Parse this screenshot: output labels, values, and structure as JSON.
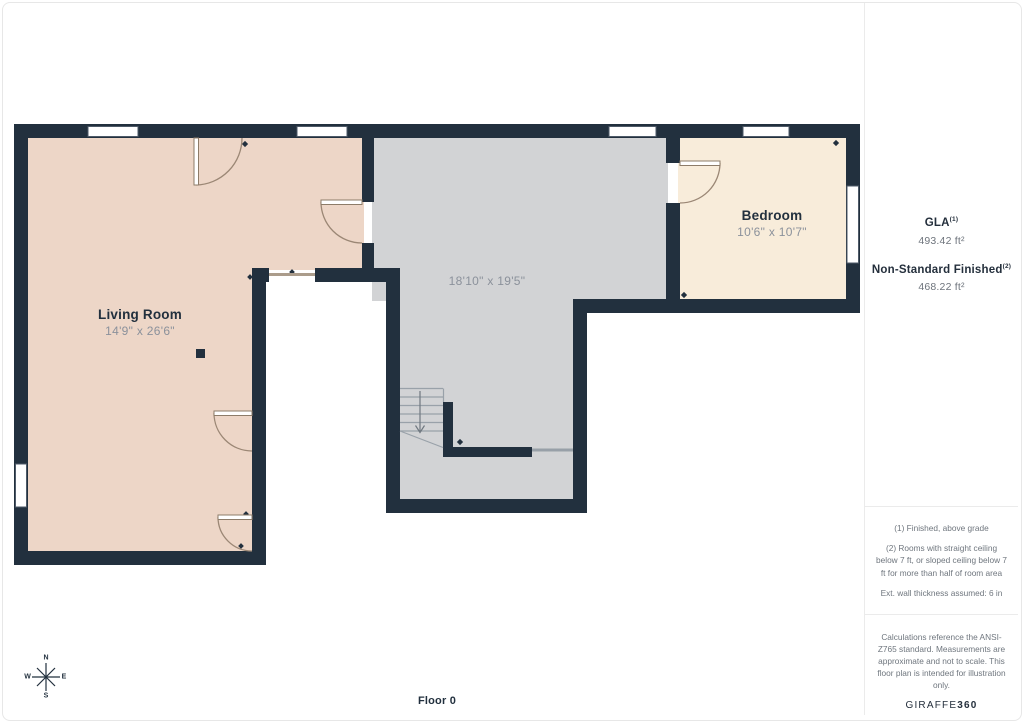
{
  "floor_plan": {
    "floor_label": "Floor 0",
    "rooms": {
      "living_room": {
        "name": "Living Room",
        "dimensions": "14'9\" x 26'6\""
      },
      "main_area": {
        "dimensions": "18'10\" x 19'5\""
      },
      "bedroom": {
        "name": "Bedroom",
        "dimensions": "10'6\" x 10'7\""
      }
    },
    "compass": {
      "north": "N",
      "south": "S",
      "east": "E",
      "west": "W"
    }
  },
  "sidebar": {
    "gla_label": "GLA",
    "gla_superscript": "(1)",
    "gla_value": "493.42 ft²",
    "nsf_label": "Non-Standard Finished",
    "nsf_superscript": "(2)",
    "nsf_value": "468.22 ft²",
    "footnotes": [
      "(1) Finished, above grade",
      "(2) Rooms with straight ceiling below 7 ft, or sloped ceiling below 7 ft for more than half of room area",
      "Ext. wall thickness assumed: 6 in"
    ],
    "disclaimer": "Calculations reference the ANSI-Z765 standard. Measurements are approximate and not to scale. This floor plan is intended for illustration only.",
    "brand_name": "GIRAFFE",
    "brand_suffix": "360"
  },
  "colors": {
    "wall": "#22303e",
    "living_room_fill": "#edd6c7",
    "main_area_fill": "#d2d3d5",
    "bedroom_fill": "#f8ecda",
    "door_arc": "#9b8775",
    "stair_line": "#99a1a9",
    "primary_text": "#22303e",
    "secondary_text": "#8b919b"
  }
}
